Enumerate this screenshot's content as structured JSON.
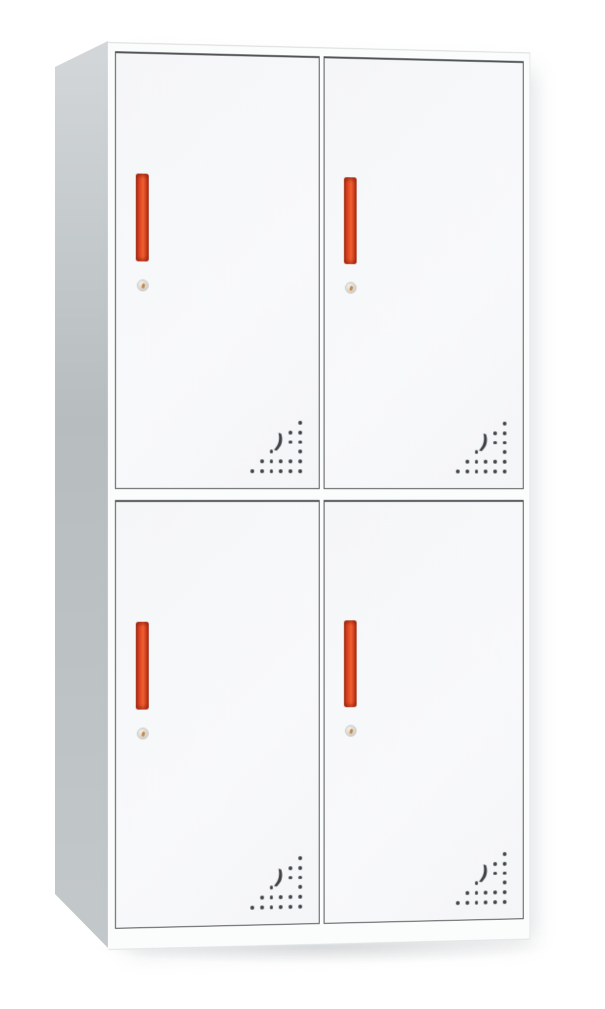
{
  "scene": {
    "description": "Product photo of a white four-compartment steel locker cabinet with red vertical handles, round keyholes and triangular perforated vent patterns, on a plain white background",
    "background_color": "#ffffff"
  },
  "locker": {
    "kind": "4-door storage locker, 2 rows x 2 columns, viewed slightly from the left",
    "doors": [
      {
        "id": "top-left",
        "row": "top",
        "col": "left"
      },
      {
        "id": "top-right",
        "row": "top",
        "col": "right"
      },
      {
        "id": "bottom-left",
        "row": "bottom",
        "col": "left"
      },
      {
        "id": "bottom-right",
        "row": "bottom",
        "col": "right"
      }
    ],
    "door_features": {
      "handle": {
        "shape": "vertical-bar",
        "color": "#d8401f"
      },
      "keyhole": {
        "shape": "round-cam-lock",
        "color": "#d9d5cf"
      },
      "vent": {
        "pattern": "right-triangle-dot-grid",
        "rows": 6,
        "skip_cells": [
          [
            3,
            4
          ],
          [
            4,
            4
          ],
          [
            4,
            5
          ]
        ],
        "crescent_glyph": ")",
        "position": "bottom-right-of-door"
      }
    },
    "colors": {
      "bg": "#ffffff",
      "side-top": "#d3d7d9",
      "side-mid": "#b7bdbf",
      "side-bottom": "#c3c8ca",
      "frame-face": "#fbfcfc",
      "door-face": "#f5f6f8",
      "door-border": "#515558",
      "handle-dark": "#a93115",
      "handle-light": "#ee6233",
      "keyhole-face": "#d9d5cf",
      "keyhole-pin": "#c08a4e",
      "vent-dot": "#3f4347"
    }
  }
}
